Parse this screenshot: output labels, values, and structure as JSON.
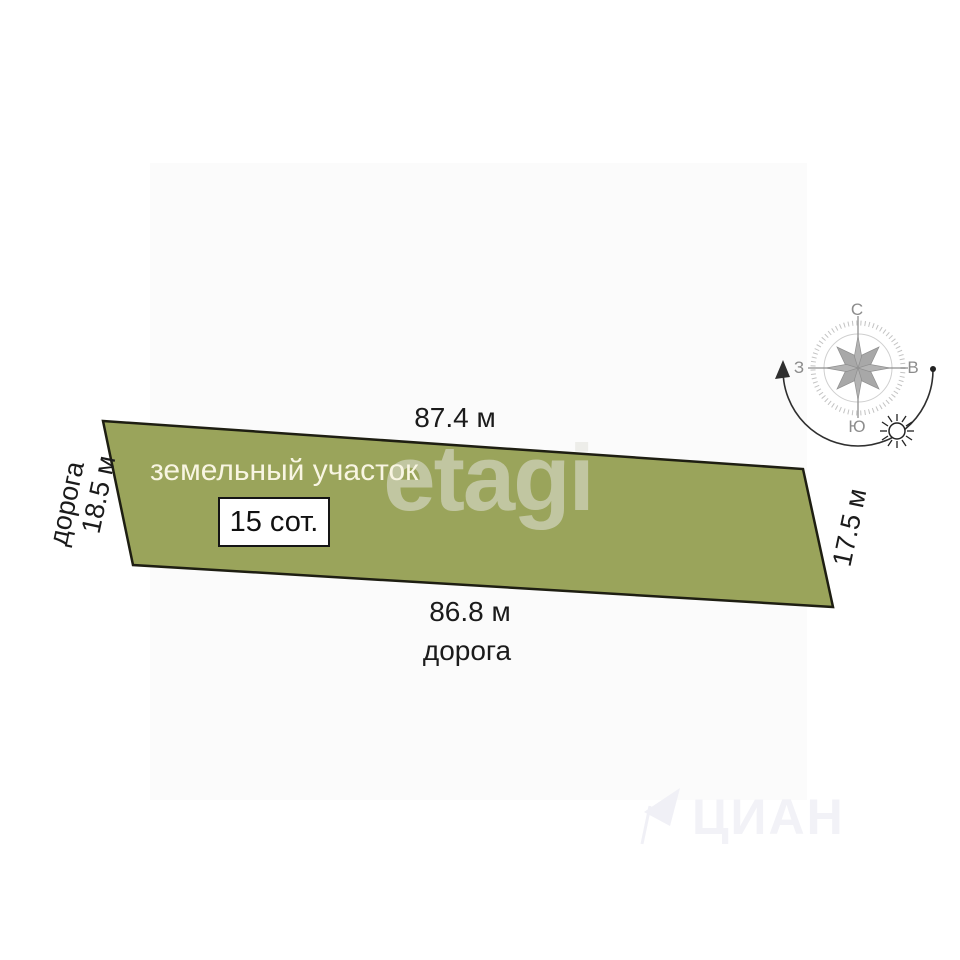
{
  "plot": {
    "label": "земельный участок",
    "area": "15 сот.",
    "side_top": "87.4 м",
    "side_bottom": "86.8 м",
    "side_left": "18.5 м",
    "side_right": "17.5 м",
    "road_left": "дорога",
    "road_bottom": "дорога",
    "fill_color": "#9aa45b",
    "outline_color": "#1e1e12"
  },
  "compass": {
    "north": "С",
    "south": "Ю",
    "west": "З",
    "east": "В"
  },
  "watermarks": {
    "center": "etagi",
    "corner": "ЦИАН"
  }
}
